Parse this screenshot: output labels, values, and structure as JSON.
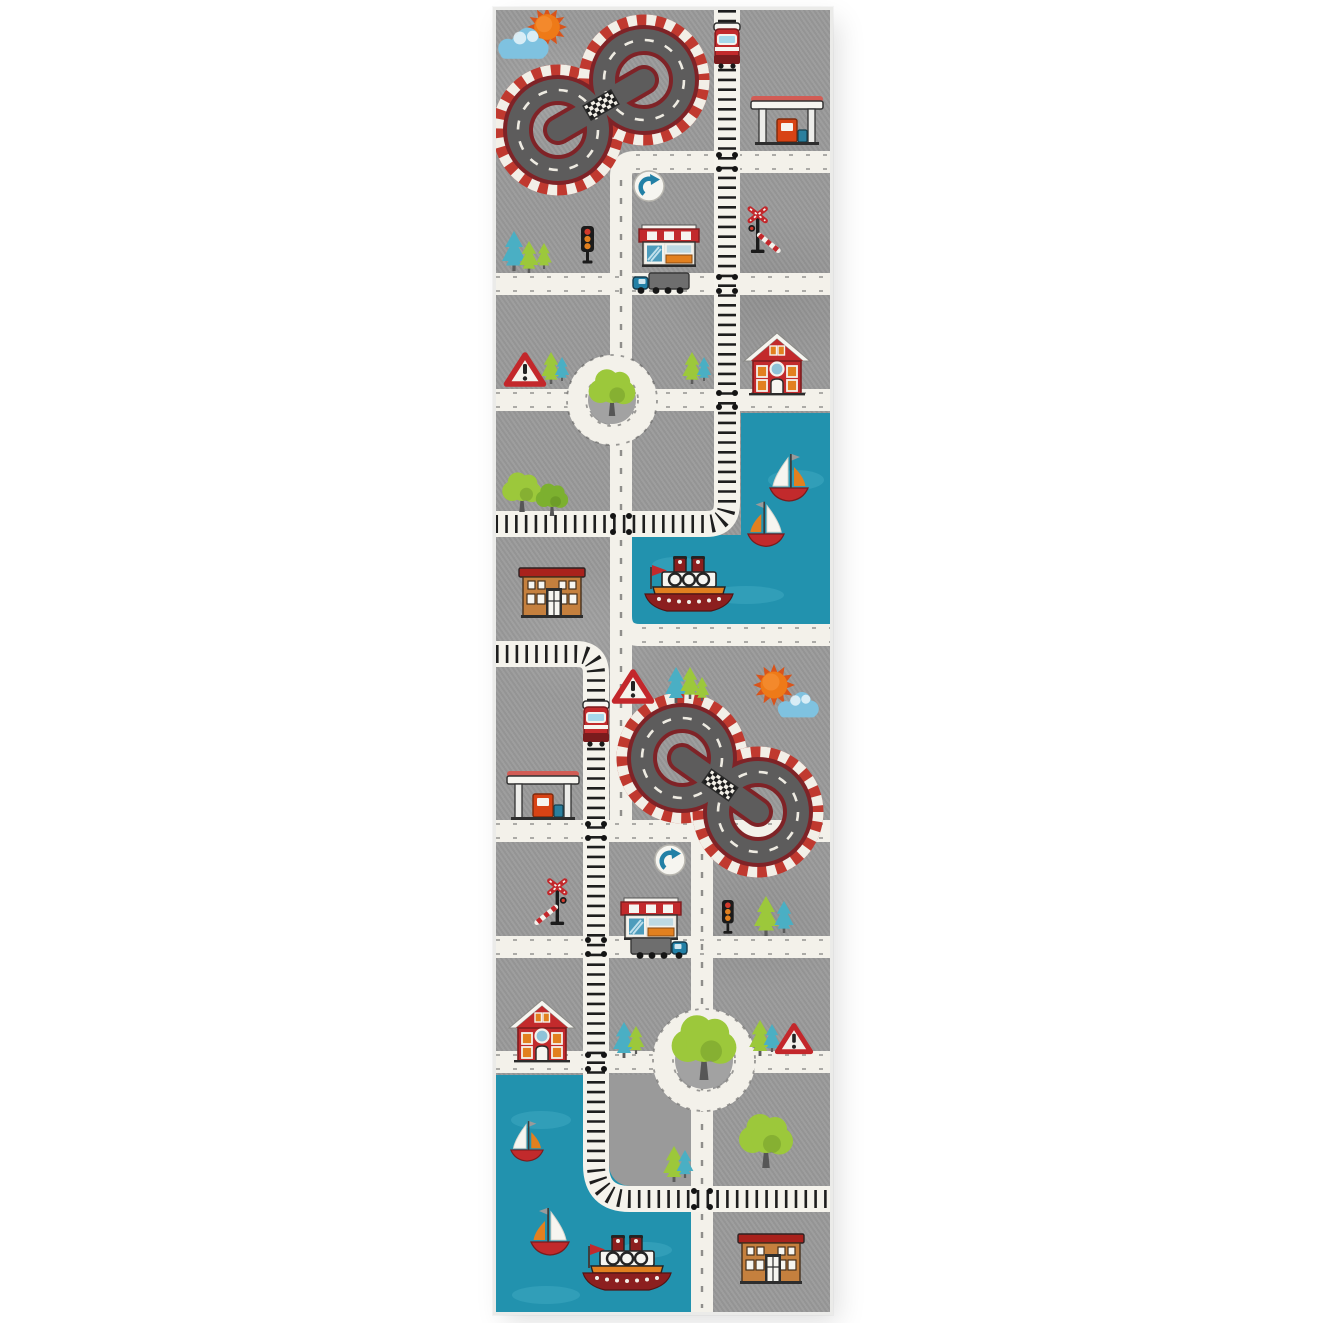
{
  "meta": {
    "alt": "Kids play rug runner with gray city road map design: two figure-eight racetracks, train tracks with red engines, roads with roundabouts, harbors with tugboats and sailboats, houses, shops, gas stations, traffic signs and trees",
    "image_type": "product photo on white background"
  },
  "colors": {
    "page_bg": "#ffffff",
    "rug_field": "#9a9a9a",
    "rug_edge": "#ebebe9",
    "road": "#f3f1ea",
    "road_tick": "#565656",
    "track_band": "#f5f3ec",
    "track_tie": "#1e1e1e",
    "asphalt": "#5d5c5c",
    "track_border": "#7f2327",
    "checker_red": "#c0392f",
    "checker_white": "#f2efe7",
    "water": "#2292ae",
    "water_light": "#45aec5",
    "sun": "#ee7a18",
    "cloud": "#7fc2e0",
    "red": "#c22a2c",
    "dark_red": "#8c1f1f",
    "orange": "#e2801f",
    "brick": "#c5803e",
    "green": "#9cc83b",
    "green_dark": "#7cb02f",
    "teal": "#4aafc4",
    "blue": "#2280a6",
    "ink": "#1d1d1d",
    "white": "#f6f5f0"
  },
  "scene": {
    "rug_shape": "vertical runner",
    "features": [
      "figure-eight racetrack with red-white checkered curbs (top left)",
      "orange sun with blue cloud (top left and middle right)",
      "vertical train track with red engine (top)",
      "gas station with canopy and pumps (top right and middle left)",
      "blue roundabout direction signs",
      "shop with red and white striped awning (two)",
      "traffic lights (two)",
      "railroad crossing signals with striped barriers (two)",
      "roundabout with tree (north and south)",
      "red cottage with round window (two)",
      "warning triangle signs (three)",
      "harbor water with tugboat and two sailboats (middle right)",
      "harbor water with tugboat and two sailboats (bottom left)",
      "orange station building (middle left and bottom right)",
      "second figure-eight racetrack (middle right)",
      "train track S-curve crossing roads (bottom)",
      "trucks with blue cabs on roads (two)",
      "pine and round deciduous trees throughout"
    ]
  }
}
